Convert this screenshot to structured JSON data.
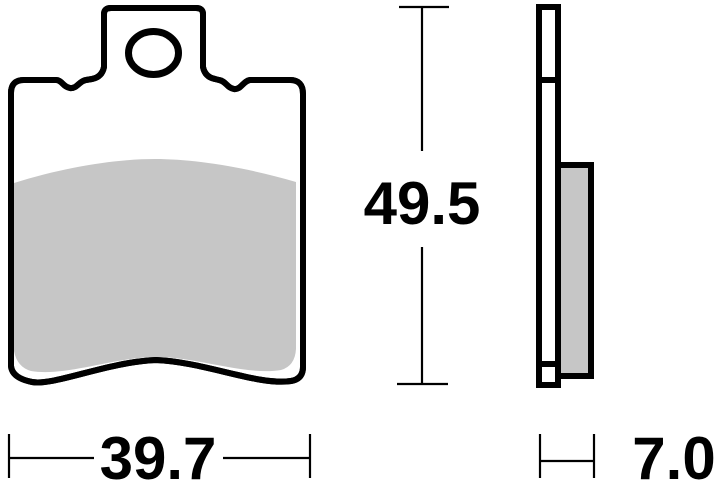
{
  "diagram": {
    "dimensions": {
      "width": "39.7",
      "height": "49.5",
      "thickness": "7.0"
    },
    "colors": {
      "outline": "#000000",
      "friction_material": "#c6c6c6",
      "background": "#ffffff"
    }
  }
}
